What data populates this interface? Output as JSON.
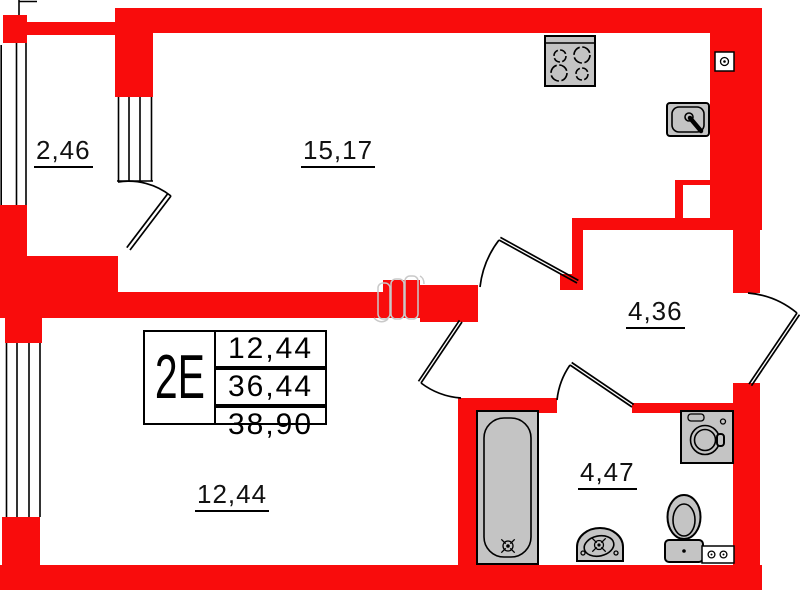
{
  "plan": {
    "unit": {
      "label": "2E"
    },
    "table": {
      "living_area": "12,44",
      "apartment_area": "36,44",
      "total_area": "38,90"
    },
    "room_labels": {
      "balcony": "2,46",
      "kitchen": "15,17",
      "hallway": "4,36",
      "bathroom": "4,47",
      "living_room": "12,44"
    },
    "fixtures": {
      "stove": "stove-icon",
      "kitchen_sink": "kitchen-sink-icon",
      "outlet": "outlet-icon",
      "bathtub": "bathtub-icon",
      "washbasin": "washbasin-icon",
      "toilet": "toilet-icon",
      "washing_machine": "washing-machine-icon",
      "socket": "socket-icon"
    },
    "colors": {
      "wall": "#f90c0c",
      "fixture": "#c4c4c4",
      "ghost": "#c9c9c9",
      "line": "#000000"
    }
  }
}
